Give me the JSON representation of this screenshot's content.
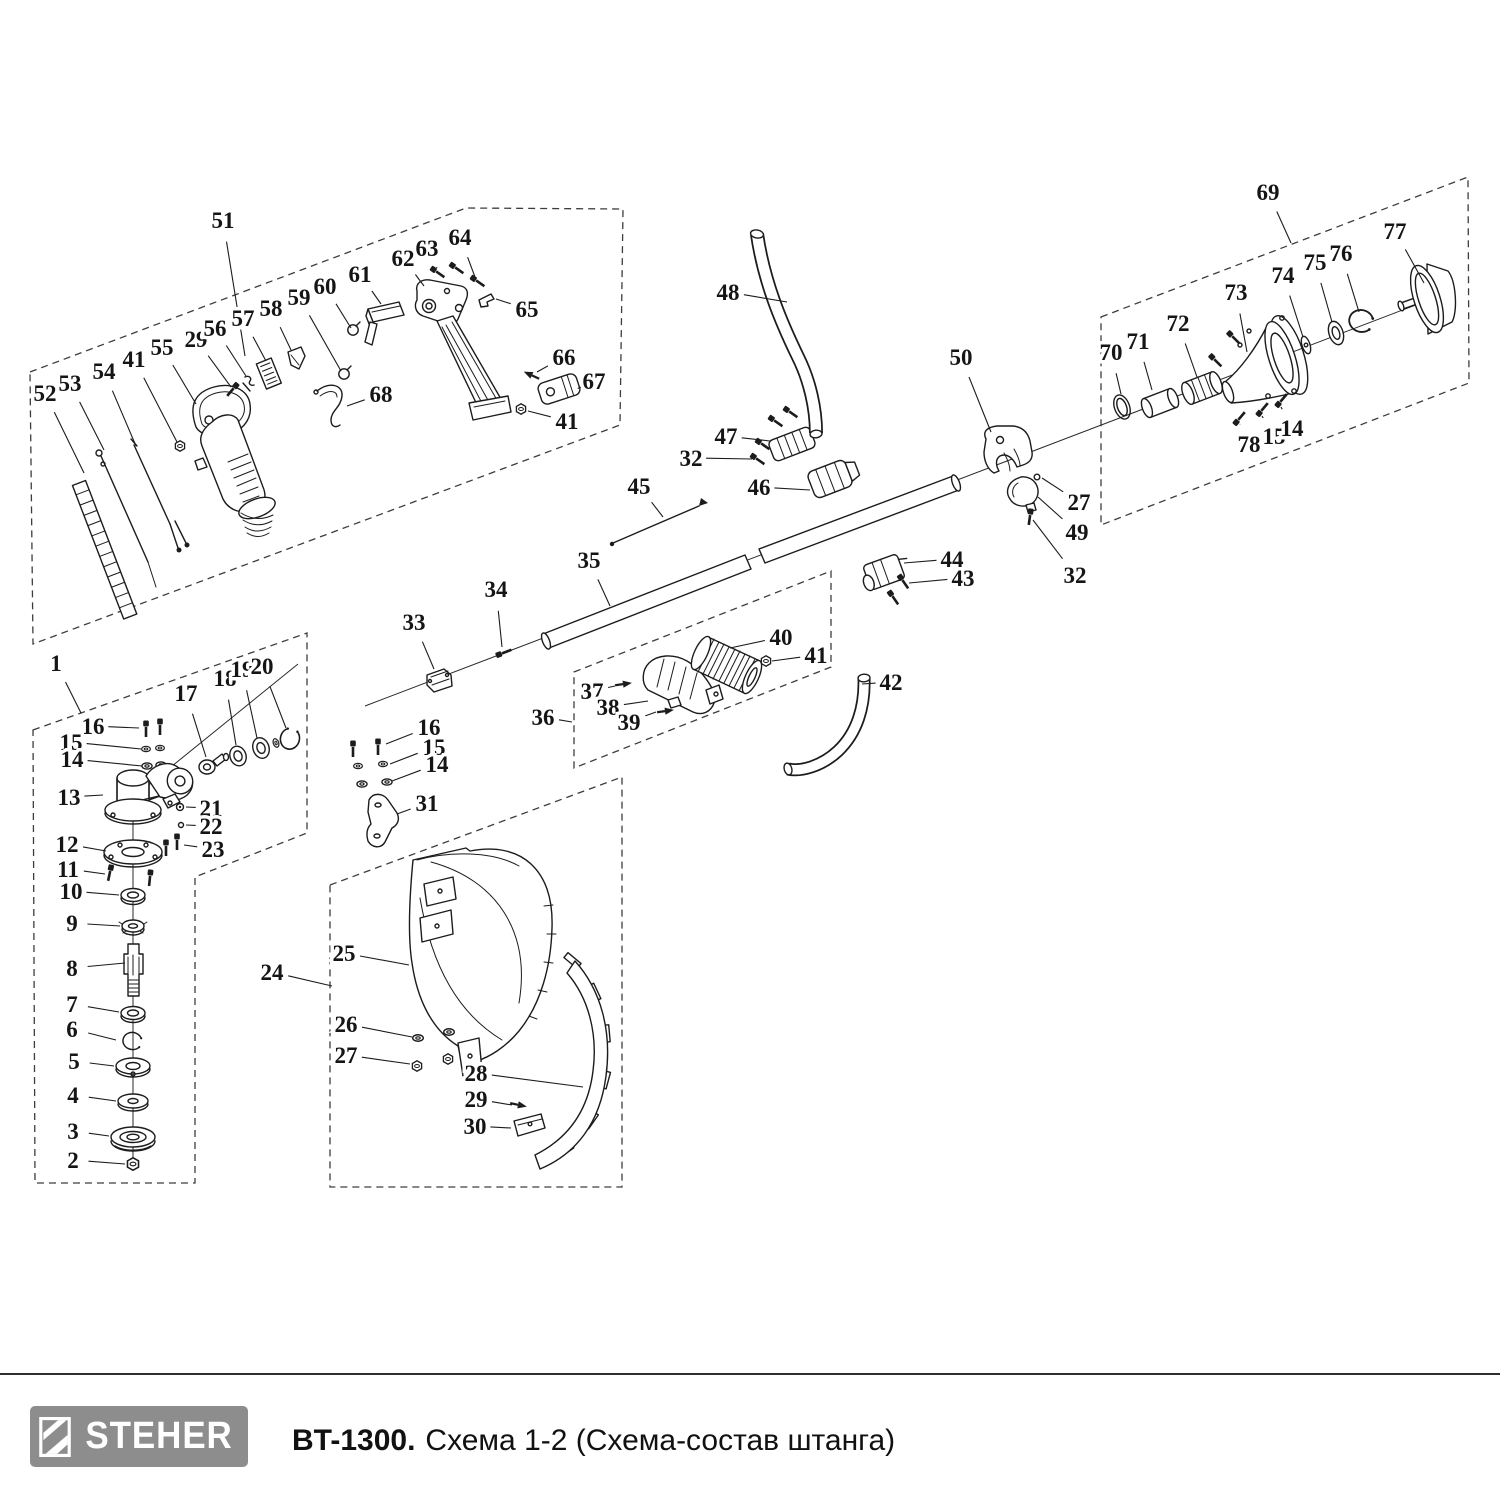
{
  "footer": {
    "brand": "STEHER",
    "model": "BT-1300.",
    "caption": "Схема 1-2 (Схема-состав штанга)"
  },
  "colors": {
    "line": "#1c1c1c",
    "logo_bg": "#8d8d8d",
    "rule": "#2e2e2e"
  },
  "diagram": {
    "callouts": [
      {
        "n": "51",
        "x": 223,
        "y": 220,
        "tx": 245,
        "ty": 356
      },
      {
        "n": "52",
        "x": 45,
        "y": 393,
        "tx": 84,
        "ty": 473
      },
      {
        "n": "53",
        "x": 70,
        "y": 383,
        "tx": 104,
        "ty": 450
      },
      {
        "n": "54",
        "x": 104,
        "y": 371,
        "tx": 136,
        "ty": 446
      },
      {
        "n": "41",
        "x": 134,
        "y": 359,
        "tx": 177,
        "ty": 442
      },
      {
        "n": "55",
        "x": 162,
        "y": 347,
        "tx": 196,
        "ty": 404
      },
      {
        "n": "29",
        "x": 196,
        "y": 339,
        "tx": 231,
        "ty": 387
      },
      {
        "n": "56",
        "x": 215,
        "y": 328,
        "tx": 246,
        "ty": 376
      },
      {
        "n": "57",
        "x": 243,
        "y": 318,
        "tx": 266,
        "ty": 361
      },
      {
        "n": "58",
        "x": 271,
        "y": 308,
        "tx": 291,
        "ty": 350
      },
      {
        "n": "59",
        "x": 299,
        "y": 297,
        "tx": 341,
        "ty": 371
      },
      {
        "n": "60",
        "x": 325,
        "y": 286,
        "tx": 351,
        "ty": 328
      },
      {
        "n": "61",
        "x": 360,
        "y": 274,
        "tx": 381,
        "ty": 304
      },
      {
        "n": "62",
        "x": 403,
        "y": 258,
        "tx": 424,
        "ty": 286
      },
      {
        "n": "63",
        "x": 427,
        "y": 248,
        "tx": 437,
        "ty": 268
      },
      {
        "n": "64",
        "x": 460,
        "y": 237,
        "tx": 475,
        "ty": 277
      },
      {
        "n": "65",
        "x": 527,
        "y": 309,
        "tx": 496,
        "ty": 299
      },
      {
        "n": "66",
        "x": 564,
        "y": 357,
        "tx": 537,
        "ty": 372
      },
      {
        "n": "67",
        "x": 594,
        "y": 381,
        "tx": 581,
        "ty": 387
      },
      {
        "n": "68",
        "x": 381,
        "y": 394,
        "tx": 347,
        "ty": 406
      },
      {
        "n": "41",
        "x": 567,
        "y": 421,
        "tx": 528,
        "ty": 411
      },
      {
        "n": "1",
        "x": 56,
        "y": 663,
        "tx": 81,
        "ty": 713
      },
      {
        "n": "16",
        "x": 93,
        "y": 726,
        "tx": 139,
        "ty": 728
      },
      {
        "n": "15",
        "x": 71,
        "y": 742,
        "tx": 141,
        "ty": 749
      },
      {
        "n": "14",
        "x": 72,
        "y": 759,
        "tx": 142,
        "ty": 766
      },
      {
        "n": "17",
        "x": 186,
        "y": 693,
        "tx": 206,
        "ty": 757
      },
      {
        "n": "18",
        "x": 225,
        "y": 678,
        "tx": 236,
        "ty": 745
      },
      {
        "n": "19",
        "x": 242,
        "y": 669,
        "tx": 257,
        "ty": 738
      },
      {
        "n": "20",
        "x": 262,
        "y": 666,
        "tx": 286,
        "ty": 728
      },
      {
        "n": "13",
        "x": 69,
        "y": 797,
        "tx": 103,
        "ty": 795
      },
      {
        "n": "21",
        "x": 211,
        "y": 808,
        "tx": 186,
        "ty": 807
      },
      {
        "n": "22",
        "x": 211,
        "y": 826,
        "tx": 186,
        "ty": 825
      },
      {
        "n": "23",
        "x": 213,
        "y": 849,
        "tx": 184,
        "ty": 845
      },
      {
        "n": "12",
        "x": 67,
        "y": 844,
        "tx": 106,
        "ty": 851
      },
      {
        "n": "11",
        "x": 68,
        "y": 869,
        "tx": 105,
        "ty": 874
      },
      {
        "n": "10",
        "x": 71,
        "y": 891,
        "tx": 119,
        "ty": 895
      },
      {
        "n": "9",
        "x": 72,
        "y": 923,
        "tx": 120,
        "ty": 926
      },
      {
        "n": "8",
        "x": 72,
        "y": 968,
        "tx": 125,
        "ty": 963
      },
      {
        "n": "7",
        "x": 72,
        "y": 1004,
        "tx": 119,
        "ty": 1012
      },
      {
        "n": "6",
        "x": 72,
        "y": 1029,
        "tx": 116,
        "ty": 1040
      },
      {
        "n": "5",
        "x": 74,
        "y": 1061,
        "tx": 114,
        "ty": 1066
      },
      {
        "n": "4",
        "x": 73,
        "y": 1095,
        "tx": 116,
        "ty": 1101
      },
      {
        "n": "3",
        "x": 73,
        "y": 1131,
        "tx": 109,
        "ty": 1136
      },
      {
        "n": "2",
        "x": 73,
        "y": 1160,
        "tx": 125,
        "ty": 1164
      },
      {
        "n": "24",
        "x": 272,
        "y": 972,
        "tx": 332,
        "ty": 986
      },
      {
        "n": "25",
        "x": 344,
        "y": 953,
        "tx": 409,
        "ty": 965
      },
      {
        "n": "31",
        "x": 427,
        "y": 803,
        "tx": 397,
        "ty": 814
      },
      {
        "n": "26",
        "x": 346,
        "y": 1024,
        "tx": 412,
        "ty": 1037
      },
      {
        "n": "27",
        "x": 346,
        "y": 1055,
        "tx": 410,
        "ty": 1064
      },
      {
        "n": "28",
        "x": 476,
        "y": 1073,
        "tx": 583,
        "ty": 1087
      },
      {
        "n": "29",
        "x": 476,
        "y": 1099,
        "tx": 512,
        "ty": 1105
      },
      {
        "n": "30",
        "x": 475,
        "y": 1126,
        "tx": 511,
        "ty": 1128
      },
      {
        "n": "33",
        "x": 414,
        "y": 622,
        "tx": 434,
        "ty": 669
      },
      {
        "n": "34",
        "x": 496,
        "y": 589,
        "tx": 502,
        "ty": 647
      },
      {
        "n": "35",
        "x": 589,
        "y": 560,
        "tx": 610,
        "ty": 606
      },
      {
        "n": "45",
        "x": 639,
        "y": 486,
        "tx": 663,
        "ty": 517
      },
      {
        "n": "16",
        "x": 429,
        "y": 727,
        "tx": 386,
        "ty": 744
      },
      {
        "n": "15",
        "x": 434,
        "y": 747,
        "tx": 390,
        "ty": 764
      },
      {
        "n": "14",
        "x": 437,
        "y": 764,
        "tx": 392,
        "ty": 781
      },
      {
        "n": "36",
        "x": 543,
        "y": 717,
        "tx": 572,
        "ty": 722
      },
      {
        "n": "37",
        "x": 592,
        "y": 691,
        "tx": 615,
        "ty": 686
      },
      {
        "n": "38",
        "x": 608,
        "y": 707,
        "tx": 648,
        "ty": 701
      },
      {
        "n": "39",
        "x": 629,
        "y": 722,
        "tx": 656,
        "ty": 712
      },
      {
        "n": "40",
        "x": 781,
        "y": 637,
        "tx": 730,
        "ty": 648
      },
      {
        "n": "41",
        "x": 816,
        "y": 655,
        "tx": 772,
        "ty": 661
      },
      {
        "n": "42",
        "x": 891,
        "y": 682,
        "tx": 862,
        "ty": 684
      },
      {
        "n": "46",
        "x": 759,
        "y": 487,
        "tx": 810,
        "ty": 490
      },
      {
        "n": "47",
        "x": 726,
        "y": 436,
        "tx": 770,
        "ty": 441
      },
      {
        "n": "32",
        "x": 691,
        "y": 458,
        "tx": 752,
        "ty": 459
      },
      {
        "n": "48",
        "x": 728,
        "y": 292,
        "tx": 787,
        "ty": 302
      },
      {
        "n": "50",
        "x": 961,
        "y": 357,
        "tx": 991,
        "ty": 432
      },
      {
        "n": "27",
        "x": 1079,
        "y": 502,
        "tx": 1042,
        "ty": 478
      },
      {
        "n": "49",
        "x": 1077,
        "y": 532,
        "tx": 1038,
        "ty": 497
      },
      {
        "n": "32",
        "x": 1075,
        "y": 575,
        "tx": 1033,
        "ty": 520
      },
      {
        "n": "44",
        "x": 952,
        "y": 559,
        "tx": 904,
        "ty": 563
      },
      {
        "n": "43",
        "x": 963,
        "y": 578,
        "tx": 909,
        "ty": 583
      },
      {
        "n": "69",
        "x": 1268,
        "y": 192,
        "tx": 1291,
        "ty": 243
      },
      {
        "n": "70",
        "x": 1111,
        "y": 352,
        "tx": 1121,
        "ty": 394
      },
      {
        "n": "71",
        "x": 1138,
        "y": 341,
        "tx": 1152,
        "ty": 390
      },
      {
        "n": "72",
        "x": 1178,
        "y": 323,
        "tx": 1197,
        "ty": 377
      },
      {
        "n": "73",
        "x": 1236,
        "y": 292,
        "tx": 1247,
        "ty": 352
      },
      {
        "n": "74",
        "x": 1283,
        "y": 275,
        "tx": 1303,
        "ty": 337
      },
      {
        "n": "75",
        "x": 1315,
        "y": 262,
        "tx": 1332,
        "ty": 322
      },
      {
        "n": "76",
        "x": 1341,
        "y": 253,
        "tx": 1359,
        "ty": 312
      },
      {
        "n": "77",
        "x": 1395,
        "y": 231,
        "tx": 1424,
        "ty": 283
      },
      {
        "n": "78",
        "x": 1249,
        "y": 444,
        "tx": 1240,
        "ty": 425
      },
      {
        "n": "15",
        "x": 1274,
        "y": 436,
        "tx": 1262,
        "ty": 416
      },
      {
        "n": "14",
        "x": 1292,
        "y": 428,
        "tx": 1281,
        "ty": 407
      }
    ]
  }
}
